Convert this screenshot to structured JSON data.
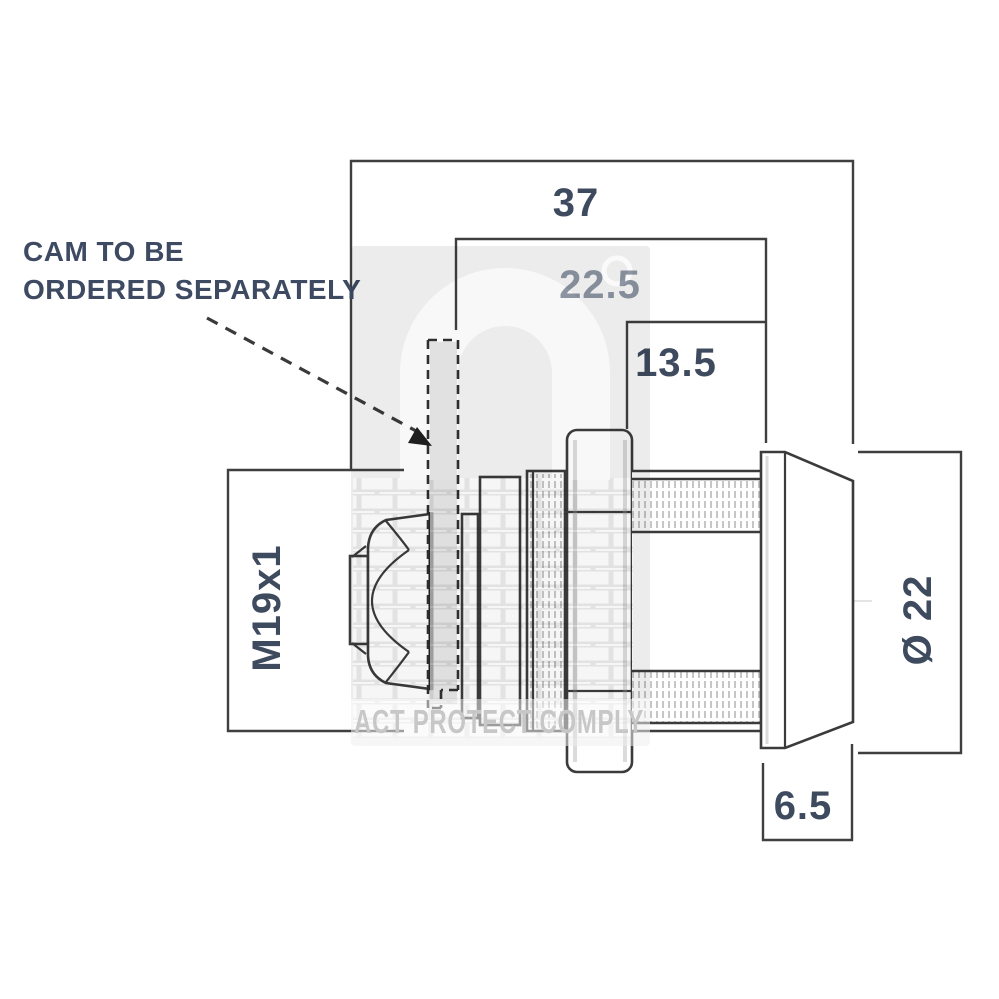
{
  "drawing": {
    "type": "technical-drawing",
    "subject": "cam lock, side elevation",
    "annotation": {
      "line1": "CAM TO BE",
      "line2": "ORDERED SEPARATELY"
    },
    "dimensions": {
      "overall_length": "37",
      "body_length": "22.5",
      "front_length": "13.5",
      "thread": "M19x1",
      "head_diameter": "Ø 22",
      "head_depth": "6.5"
    }
  },
  "watermark": {
    "text": "ACT PROTECT COMPLY"
  },
  "colors": {
    "line": "#3b3b3b",
    "dimension_text": "#3e4a5e",
    "dimension_text_faded": "#9098a6",
    "annotation_text": "#3d4a61",
    "watermark_badge": "#ececec",
    "watermark_shape": "#f8f8f8",
    "watermark_text": "#c7c7c7"
  }
}
